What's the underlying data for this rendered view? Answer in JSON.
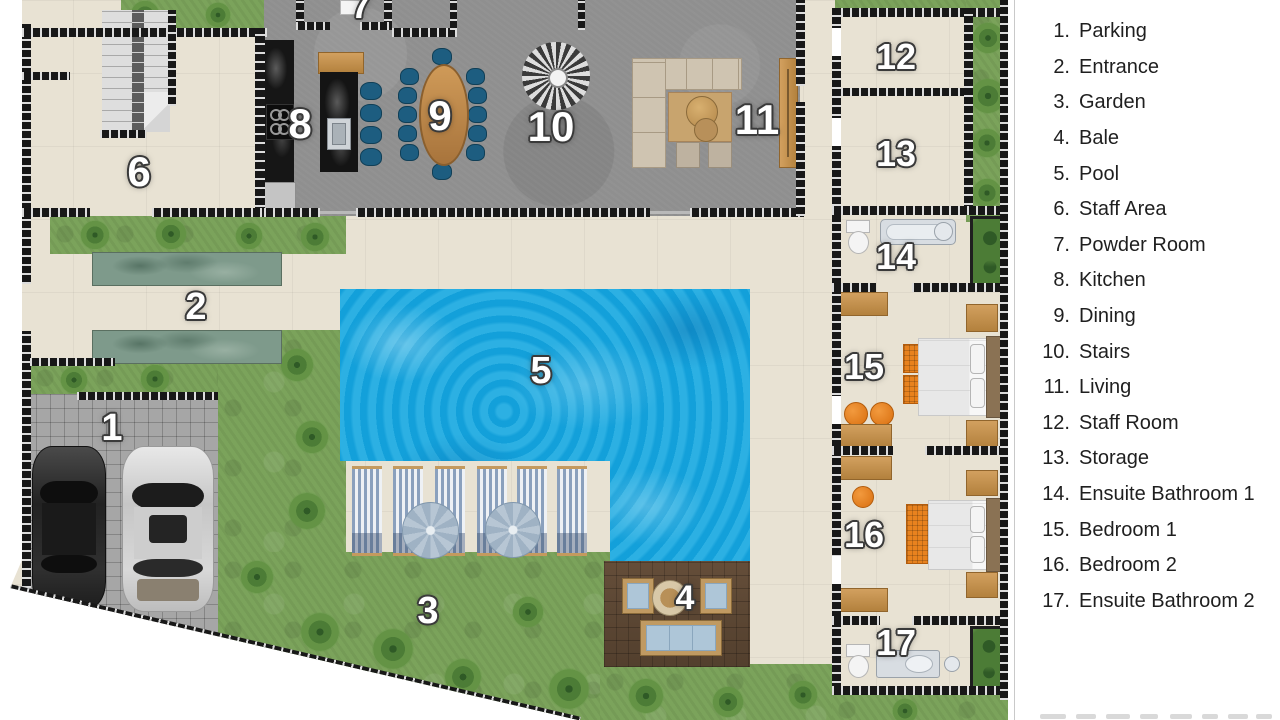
{
  "rooms": [
    {
      "marker": "1",
      "num": "1.",
      "label": "Parking"
    },
    {
      "marker": "2",
      "num": "2.",
      "label": "Entrance"
    },
    {
      "marker": "3",
      "num": "3.",
      "label": "Garden"
    },
    {
      "marker": "4",
      "num": "4.",
      "label": "Bale"
    },
    {
      "marker": "5",
      "num": "5.",
      "label": "Pool"
    },
    {
      "marker": "6",
      "num": "6.",
      "label": "Staff Area"
    },
    {
      "marker": "7",
      "num": "7.",
      "label": "Powder Room"
    },
    {
      "marker": "8",
      "num": "8.",
      "label": "Kitchen"
    },
    {
      "marker": "9",
      "num": "9.",
      "label": "Dining"
    },
    {
      "marker": "10",
      "num": "10.",
      "label": "Stairs"
    },
    {
      "marker": "11",
      "num": "11.",
      "label": "Living"
    },
    {
      "marker": "12",
      "num": "12.",
      "label": "Staff Room"
    },
    {
      "marker": "13",
      "num": "13.",
      "label": "Storage"
    },
    {
      "marker": "14",
      "num": "14.",
      "label": "Ensuite Bathroom 1"
    },
    {
      "marker": "15",
      "num": "15.",
      "label": "Bedroom 1"
    },
    {
      "marker": "16",
      "num": "16.",
      "label": "Bedroom 2"
    },
    {
      "marker": "17",
      "num": "17.",
      "label": "Ensuite Bathroom 2"
    }
  ],
  "colors": {
    "pool": "#14a7e0",
    "grass": "#7ba35b",
    "wall": "#181818",
    "floor_beige": "#e8e2d3",
    "floor_gray": "#8f8f8f",
    "wood": "#c08a50",
    "accent_blue": "#1d5d80",
    "accent_orange": "#e8821e"
  }
}
